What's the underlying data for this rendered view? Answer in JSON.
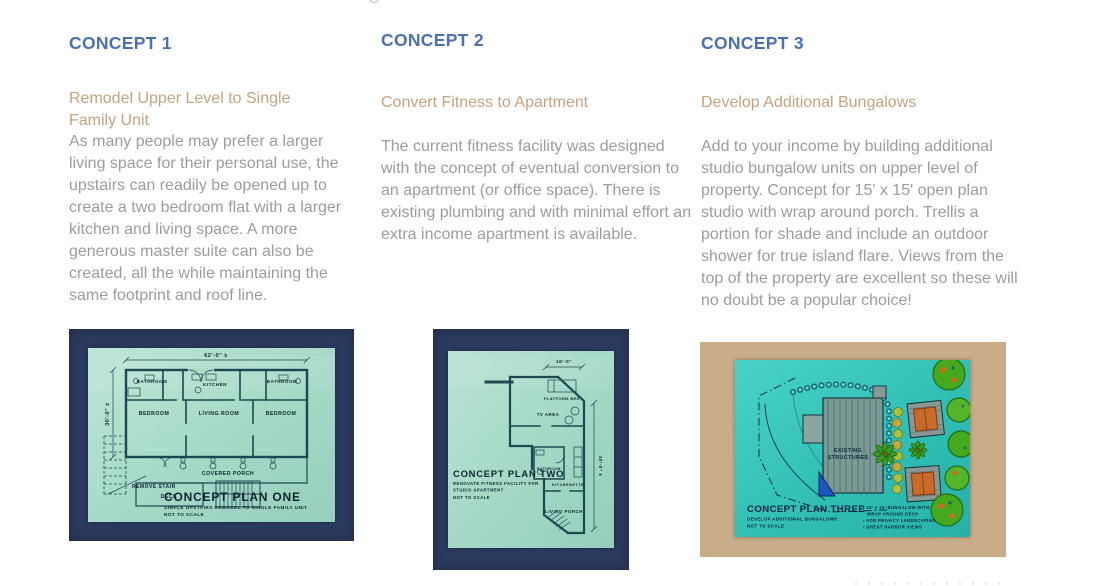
{
  "colors": {
    "heading_blue": "#4a6fb3",
    "subheading_tan": "#c4a381",
    "body_gray": "#9c9c9c",
    "frame_navy": "#2b3a5f",
    "paper_green": "#a8dcc8",
    "plan_ink": "#1c4852",
    "plan_text": "#0d2430",
    "site_frame_tan": "#c9ad88",
    "site_paper_turquoise": "#35c3ba",
    "site_text": "#0d2440"
  },
  "concepts": [
    {
      "heading": "CONCEPT 1",
      "subheading": "Remodel Upper Level to Single Family Unit",
      "body": "As many people may prefer a larger living space for their personal use, the upstairs can readily be opened up to create a two bedroom flat with a larger kitchen and living space. A more generous master suite can also be created, all the while maintaining the same footprint and roof line.",
      "plan": {
        "title": "CONCEPT PLAN ONE",
        "subtitle": "SIMPLE UPSTAIRS REMODEL TO SINGLE FAMILY UNIT",
        "scale_note": "NOT TO SCALE",
        "dim_top": "62'-0\" ±",
        "dim_left": "30'-0\" ±",
        "labels": {
          "bath_left": "BATHROOM",
          "kitchen": "KITCHEN",
          "bath_right": "BATHROOM",
          "bed_left": "BEDROOM",
          "living": "LIVING ROOM",
          "bed_right": "BEDROOM",
          "porch": "COVERED PORCH",
          "deck": "DECK",
          "stair_note": "REMOVE STAIR"
        }
      }
    },
    {
      "heading": "CONCEPT 2",
      "subheading": "Convert Fitness to Apartment",
      "body": "The current fitness facility was designed with the concept of eventual conversion to an apartment (or office space). There is existing plumbing and with minimal effort an extra income apartment is available.",
      "plan": {
        "title": "CONCEPT PLAN TWO",
        "subtitle_line1": "RENOVATE FITNESS FACILITY FOR",
        "subtitle_line2": "STUDIO APARTMENT",
        "scale_note": "NOT TO SCALE",
        "dim_top": "16'-0\"",
        "dim_right": "40'-0\" ±",
        "labels": {
          "platform_bed": "PLATFORM BED",
          "tv_area": "TV AREA",
          "bathroom": "BATHROOM",
          "kitchenette": "KITCHENETTE",
          "living_porch": "LIVING PORCH"
        }
      }
    },
    {
      "heading": "CONCEPT 3",
      "subheading": "Develop Additional Bungalows",
      "body": "Add to your income by building additional studio bungalow units on upper level of property. Concept for 15' x 15' open plan studio with wrap around porch. Trellis a portion for shade and include an outdoor shower for true island flare. Views from the top of the property are excellent so these will no doubt be a popular choice!",
      "plan": {
        "title": "CONCEPT PLAN THREE",
        "subtitle": "DEVELOP ADDITIONAL BUNGALOWS",
        "scale_note": "NOT TO SCALE",
        "labels": {
          "existing_line1": "EXISTING",
          "existing_line2": "STRUCTURES"
        },
        "bullets": {
          "b1_line1": "• 15' x 15' BUNGALOW WITH",
          "b1_line2": "WRAP AROUND DECK",
          "b2": "• ADD PRIVACY LANDSCAPING",
          "b3": "• GREAT HARBOR VIEWS"
        }
      }
    }
  ]
}
